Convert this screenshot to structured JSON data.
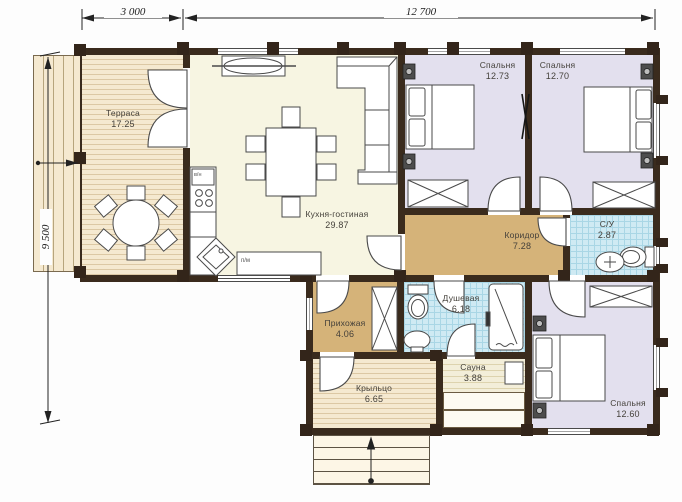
{
  "title": "План первого этажа (floor plan)",
  "dimensions": {
    "top_left": "3 000",
    "top_right": "12 700",
    "left": "9 500"
  },
  "rooms": [
    {
      "name": "Терраса",
      "area": "17.25"
    },
    {
      "name": "Кухня-гостиная",
      "area": "29.87"
    },
    {
      "name": "Спальня",
      "area": "12.73"
    },
    {
      "name": "Спальня",
      "area": "12.70"
    },
    {
      "name": "Коридор",
      "area": "7.28"
    },
    {
      "name": "С/У",
      "area": "2.87"
    },
    {
      "name": "Душевая",
      "area": "6.18"
    },
    {
      "name": "Прихожая",
      "area": "4.06"
    },
    {
      "name": "Сауна",
      "area": "3.88"
    },
    {
      "name": "Спальня",
      "area": "12.60"
    },
    {
      "name": "Крыльцо",
      "area": "6.65"
    }
  ],
  "annotations": {
    "dishwasher": "п/м",
    "water_heater": "в/н"
  },
  "colors": {
    "walls": "#3a2b1d",
    "terrace_decking": "#f5e9d0",
    "kitchen_living": "#f7f5e2",
    "bedrooms": "#e3e0ee",
    "hallway_corridor": "#d5b379",
    "wet_rooms_tile": "#cfeaf3",
    "line_work": "#4a4a4a"
  }
}
